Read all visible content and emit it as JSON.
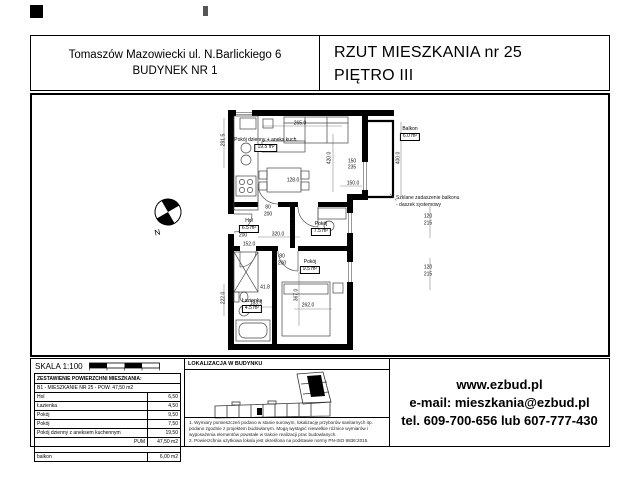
{
  "header": {
    "address_line1": "Tomaszów Mazowiecki ul. N.Barlickiego 6",
    "address_line2": "BUDYNEK NR 1",
    "title_line1": "RZUT MIESZKANIA  nr 25",
    "title_line2": "PIĘTRO III"
  },
  "plan": {
    "compass_label": "N",
    "balcony_note_line1": "Szklane zadaszenie balkonu",
    "balcony_note_line2": "- daszek systemowy",
    "rooms": [
      {
        "name": "Pokój dzienny + aneks kuch.",
        "area": "19.5 m²",
        "x": 266,
        "y": 138
      },
      {
        "name": "Balkon",
        "area": "6.0 m²",
        "x": 410,
        "y": 127
      },
      {
        "name": "Hol",
        "area": "6.5 m²",
        "x": 249,
        "y": 219
      },
      {
        "name": "Pokój",
        "area": "7.5 m²",
        "x": 321,
        "y": 222
      },
      {
        "name": "Pokój",
        "area": "9.5 m²",
        "x": 310,
        "y": 260
      },
      {
        "name": "Łazienka",
        "area": "4.5 m²",
        "x": 252,
        "y": 299
      }
    ],
    "dims": [
      {
        "t": "265.0",
        "x": 300,
        "y": 124
      },
      {
        "t": "291.5",
        "x": 224,
        "y": 140,
        "r": 1
      },
      {
        "t": "420.0",
        "x": 330,
        "y": 158,
        "r": 1
      },
      {
        "t": "128.0",
        "x": 293,
        "y": 181
      },
      {
        "t": "400.0",
        "x": 399,
        "y": 158,
        "r": 1
      },
      {
        "t": "150",
        "x": 352,
        "y": 162
      },
      {
        "t": "235",
        "x": 352,
        "y": 168
      },
      {
        "t": "150.0",
        "x": 353,
        "y": 184
      },
      {
        "t": "80",
        "x": 268,
        "y": 208
      },
      {
        "t": "200",
        "x": 268,
        "y": 215
      },
      {
        "t": "80",
        "x": 243,
        "y": 229
      },
      {
        "t": "200",
        "x": 243,
        "y": 236
      },
      {
        "t": "342.0",
        "x": 294,
        "y": 224,
        "r": 1
      },
      {
        "t": "320.0",
        "x": 278,
        "y": 235
      },
      {
        "t": "152.0",
        "x": 249,
        "y": 245
      },
      {
        "t": "80",
        "x": 282,
        "y": 257
      },
      {
        "t": "200",
        "x": 282,
        "y": 264
      },
      {
        "t": "120",
        "x": 428,
        "y": 217
      },
      {
        "t": "215",
        "x": 428,
        "y": 224
      },
      {
        "t": "120",
        "x": 428,
        "y": 268
      },
      {
        "t": "215",
        "x": 428,
        "y": 275
      },
      {
        "t": "222.0",
        "x": 224,
        "y": 298,
        "r": 1
      },
      {
        "t": "183.5",
        "x": 256,
        "y": 304
      },
      {
        "t": "41.8",
        "x": 265,
        "y": 288
      },
      {
        "t": "367.0",
        "x": 297,
        "y": 295,
        "r": 1
      },
      {
        "t": "262.0",
        "x": 308,
        "y": 306
      }
    ]
  },
  "scale": {
    "label": "SKALA 1:100"
  },
  "area_table": {
    "title": "ZESTAWIENIE POWIERZCHNI MIESZKANIA:",
    "subtitle": "B1 - MIESZKANIE NR 25 - POW. 47,50 m2",
    "rows": [
      {
        "label": "Hol",
        "value": "6,50"
      },
      {
        "label": "Łazienka",
        "value": "4,50"
      },
      {
        "label": "Pokój",
        "value": "9,50"
      },
      {
        "label": "Pokój",
        "value": "7,50"
      },
      {
        "label": "Pokój dzienny z aneksem kuchennym",
        "value": "19,50"
      }
    ],
    "total_label": "PUM",
    "total_value": "47,50 m2",
    "balcony_label": "balkon",
    "balcony_value": "6,00 m2"
  },
  "location": {
    "title": "LOKALIZACJA W BUDYNKU",
    "notes": [
      "1. Wymiary pomieszczeń podano w stanie surowym, lokalizację przyborów sanitarnych itp. podano zgodnie z projektem budowlanym. Mogą wystąpić niewielkie różnice wymiarów i wyposażenia elementów powstałe w trakcie realizacji prac budowlanych.",
      "2. Powierzchnia użytkowa lokalu jest określona na podstawie normy PN-ISO 9836:2015."
    ]
  },
  "contact": {
    "www": "www.ezbud.pl",
    "email": "e-mail: mieszkania@ezbud.pl",
    "phone": "tel. 609-700-656 lub 607-777-430"
  }
}
